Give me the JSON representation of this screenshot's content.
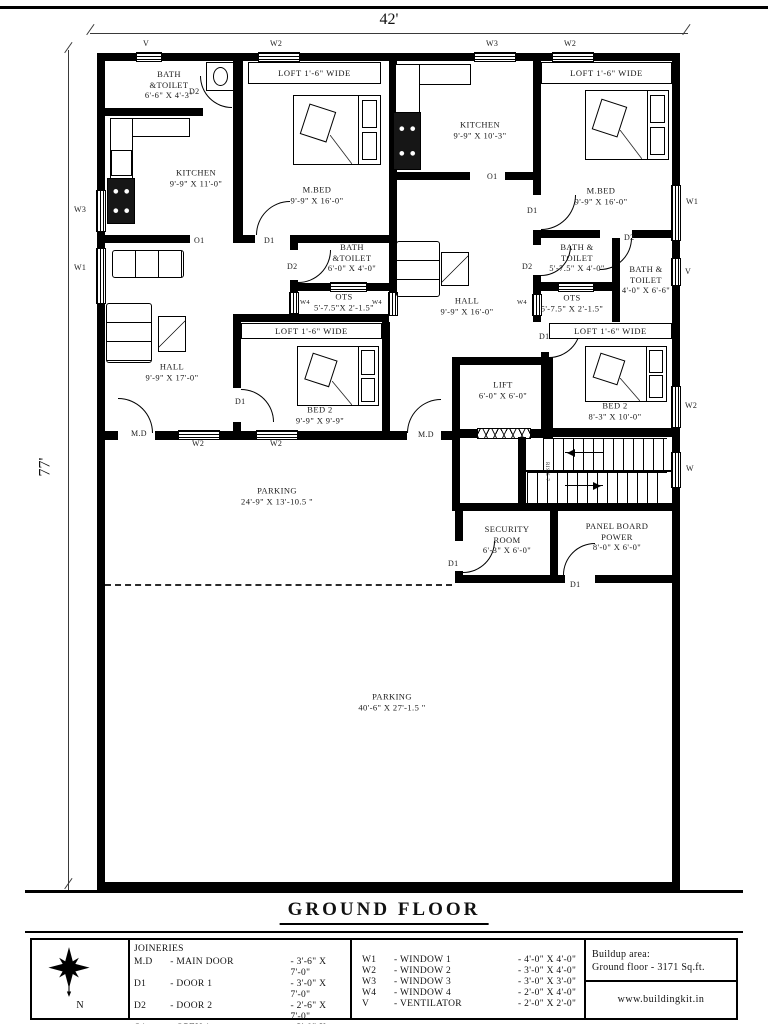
{
  "page": {
    "title": "GROUND FLOOR"
  },
  "dims": {
    "width": "42'",
    "height": "77'"
  },
  "rooms": [
    {
      "label": "BATH\n&TOILET\n6'-6\" X 4'-3\""
    },
    {
      "label": "LOFT 1'-6\" WIDE"
    },
    {
      "label": "KITCHEN\n9'-9\" X 11'-0\""
    },
    {
      "label": "M.BED\n9'-9\" X 16'-0\""
    },
    {
      "label": "KITCHEN\n9'-9\" X 10'-3\""
    },
    {
      "label": "LOFT 1'-6\" WIDE"
    },
    {
      "label": "M.BED\n9'-9\" X 16'-0\""
    },
    {
      "label": "BATH\n&TOILET\n6'-0\" X 4'-0\""
    },
    {
      "label": "OTS\n5'-7.5\"X 2'-1.5\""
    },
    {
      "label": "HALL\n9'-9\" X 16'-0\""
    },
    {
      "label": "BATH &\nTOILET\n5'-7.5\" X 4'-0\""
    },
    {
      "label": "BATH &\nTOILET\n4'-0\" X 6'-6\""
    },
    {
      "label": "OTS\n5'-7.5\" X 2'-1.5\""
    },
    {
      "label": "HALL\n9'-9\" X 17'-0\""
    },
    {
      "label": "LOFT 1'-6\" WIDE"
    },
    {
      "label": "BED 2\n9'-9\" X 9'-9\""
    },
    {
      "label": "LOFT 1'-6\" WIDE"
    },
    {
      "label": "LIFT\n6'-0\" X 6'-0\""
    },
    {
      "label": "BED 2\n8'-3\" X 10'-0\""
    },
    {
      "label": "PARKING\n24'-9\" X 13'-10.5 \""
    },
    {
      "label": "SECURITY\nROOM\n6'-3\" X 6'-0\""
    },
    {
      "label": "PANEL BOARD\nPOWER\n8'-0\" X 6'-0\""
    },
    {
      "label": "PARKING\n40'-6\" X 27'-1.5 \""
    }
  ],
  "tags": [
    {
      "t": "V"
    },
    {
      "t": "W2"
    },
    {
      "t": "W3"
    },
    {
      "t": "W2"
    },
    {
      "t": "W3"
    },
    {
      "t": "W1"
    },
    {
      "t": "D2"
    },
    {
      "t": "O1"
    },
    {
      "t": "D1"
    },
    {
      "t": "D2"
    },
    {
      "t": "O1"
    },
    {
      "t": "D1"
    },
    {
      "t": "D2"
    },
    {
      "t": "D2"
    },
    {
      "t": "W4"
    },
    {
      "t": "W4"
    },
    {
      "t": "W4"
    },
    {
      "t": "W1"
    },
    {
      "t": "V"
    },
    {
      "t": "W2"
    },
    {
      "t": "W"
    },
    {
      "t": "D1"
    },
    {
      "t": "D1"
    },
    {
      "t": "M.D"
    },
    {
      "t": "W2"
    },
    {
      "t": "W2"
    },
    {
      "t": "M.D"
    },
    {
      "t": "D1"
    },
    {
      "t": "D1"
    }
  ],
  "stairs": {
    "note": "RIS.6-7"
  },
  "legend": {
    "compass": "N",
    "joineries": {
      "title": "JOINERIES",
      "rows": [
        {
          "code": "M.D",
          "name": "- MAIN DOOR",
          "size": "- 3'-6\" X 7'-0\""
        },
        {
          "code": "D1",
          "name": "- DOOR 1",
          "size": "- 3'-0\" X 7'-0\""
        },
        {
          "code": "D2",
          "name": "- DOOR 2",
          "size": "- 2'-6\" X 7'-0\""
        },
        {
          "code": "O1",
          "name": "- OPEN 1",
          "size": "- 3'-0\" X 7'-0\""
        },
        {
          "code": "O2",
          "name": "- OPEN 2",
          "size": "- 4'-0\" X 7'-0\""
        }
      ]
    },
    "windows": {
      "rows": [
        {
          "code": "W1",
          "name": "- WINDOW 1",
          "size": "- 4'-0\" X 4'-0\""
        },
        {
          "code": "W2",
          "name": "- WINDOW 2",
          "size": "- 3'-0\" X 4'-0\""
        },
        {
          "code": "W3",
          "name": "- WINDOW 3",
          "size": "- 3'-0\" X 3'-0\""
        },
        {
          "code": "W4",
          "name": "- WINDOW 4",
          "size": "- 2'-0\" X 4'-0\""
        },
        {
          "code": "V",
          "name": "- VENTILATOR",
          "size": "- 2'-0\" X 2'-0\""
        }
      ]
    },
    "buildup": {
      "line1": "Buildup area:",
      "line2": "Ground floor - 3171 Sq.ft.",
      "website": "www.buildingkit.in"
    }
  }
}
